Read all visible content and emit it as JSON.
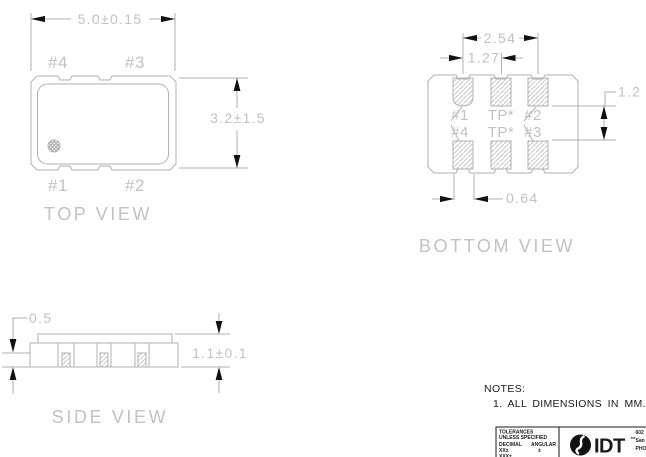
{
  "colors": {
    "drawing_line": "#b2b2b2",
    "drawing_text": "#c2c2c2",
    "arrowhead": "#111111",
    "ink_text": "#1a1a1a",
    "background": "#ffffff"
  },
  "views": {
    "top": {
      "label": "TOP VIEW",
      "dim_width": "5.0±0.15",
      "dim_height": "3.2±1.5",
      "pin_top_left": "#4",
      "pin_top_right": "#3",
      "pin_bottom_left": "#1",
      "pin_bottom_right": "#2"
    },
    "bottom": {
      "label": "BOTTOM VIEW",
      "dim_outer_pitch": "2.54",
      "dim_inner_pitch": "1.27",
      "dim_row_gap": "1.2",
      "dim_pad_width": "0.64",
      "pads": [
        [
          "#1",
          "TP*",
          "#2"
        ],
        [
          "#4",
          "TP*",
          "#3"
        ]
      ]
    },
    "side": {
      "label": "SIDE VIEW",
      "dim_base": "0.5",
      "dim_height": "1.1±0.1"
    }
  },
  "notes": {
    "heading": "NOTES:",
    "items": [
      "1. ALL DIMENSIONS IN MM."
    ]
  },
  "title_block": {
    "line1": "TOLERANCES",
    "line2": "UNLESS SPECIFIED",
    "decimal_label": "DECIMAL",
    "angular_label": "ANGULAR",
    "decimal_tol": "XX±",
    "angular_tol": "±",
    "decimal_tol2": "XXX±",
    "logo": "IDT",
    "trademark": "™",
    "address": [
      "602",
      "San",
      "PHO"
    ]
  }
}
